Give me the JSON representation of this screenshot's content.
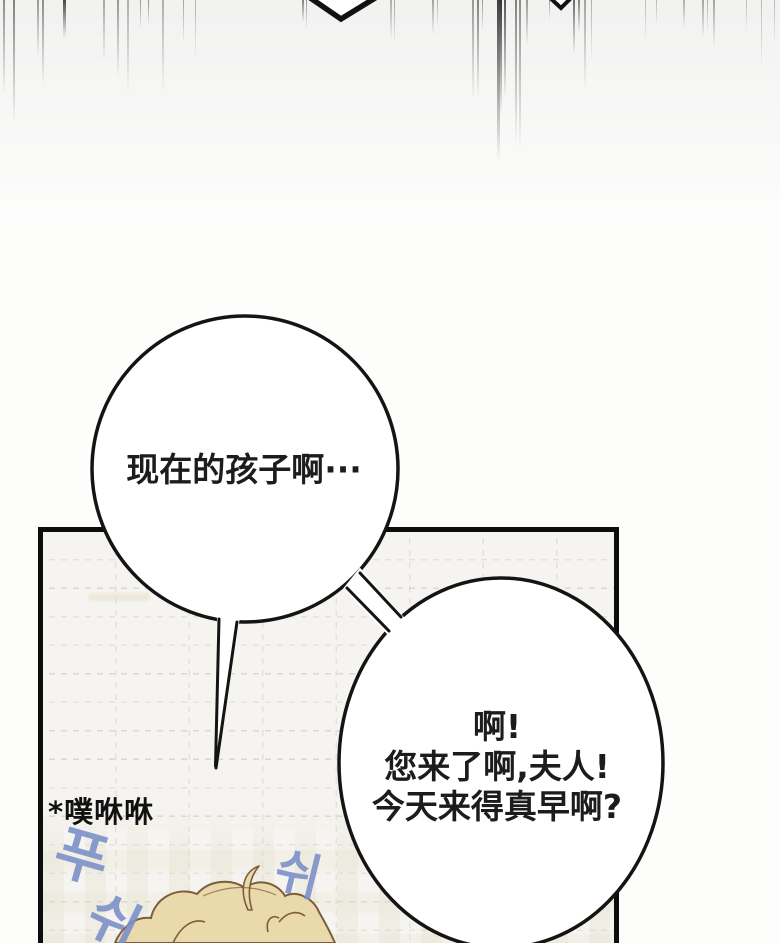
{
  "bubbles": {
    "bubble1": {
      "text": "现在的孩子啊···"
    },
    "bubble2": {
      "lines": [
        "啊!",
        "您来了啊,夫人!",
        "今天来得真早啊?"
      ]
    }
  },
  "caption": {
    "text": "*噗咻咻"
  },
  "sfx": {
    "left_top": {
      "text": "푸"
    },
    "left_bottom": {
      "text": "쉬"
    },
    "right": {
      "text": "쉬"
    }
  },
  "colors": {
    "ink": "#111111",
    "bubble_outline": "#141414",
    "bubble_fill": "#ffffff",
    "text": "#1c1c1c",
    "panel_bg": "#f5f4f0",
    "panel_border": "#0d0d0d",
    "hair_fill": "#ead9aa",
    "hair_line": "#7c5c3c",
    "sfx_blue": "#7a8ec9"
  },
  "speed_lines": [
    {
      "x": 3,
      "h": 95,
      "w": 2,
      "o": 0.45
    },
    {
      "x": 13,
      "h": 125,
      "w": 2,
      "o": 0.5
    },
    {
      "x": 37,
      "h": 58,
      "w": 1.5,
      "o": 0.4
    },
    {
      "x": 42,
      "h": 85,
      "w": 2,
      "o": 0.45
    },
    {
      "x": 63,
      "h": 38,
      "w": 2.5,
      "o": 0.75
    },
    {
      "x": 103,
      "h": 62,
      "w": 2,
      "o": 0.35
    },
    {
      "x": 117,
      "h": 78,
      "w": 1.5,
      "o": 0.4
    },
    {
      "x": 127,
      "h": 95,
      "w": 1.5,
      "o": 0.3
    },
    {
      "x": 140,
      "h": 30,
      "w": 1,
      "o": 0.4
    },
    {
      "x": 148,
      "h": 25,
      "w": 1,
      "o": 0.45
    },
    {
      "x": 162,
      "h": 93,
      "w": 1.5,
      "o": 0.3
    },
    {
      "x": 183,
      "h": 45,
      "w": 1,
      "o": 0.35
    },
    {
      "x": 195,
      "h": 60,
      "w": 1,
      "o": 0.3
    },
    {
      "x": 302,
      "h": 22,
      "w": 1.5,
      "o": 0.5
    },
    {
      "x": 306,
      "h": 30,
      "w": 1,
      "o": 0.4
    },
    {
      "x": 390,
      "h": 40,
      "w": 1.5,
      "o": 0.3
    },
    {
      "x": 394,
      "h": 45,
      "w": 1,
      "o": 0.35
    },
    {
      "x": 432,
      "h": 35,
      "w": 1.5,
      "o": 0.35
    },
    {
      "x": 437,
      "h": 28,
      "w": 1,
      "o": 0.3
    },
    {
      "x": 472,
      "h": 100,
      "w": 1.5,
      "o": 0.4
    },
    {
      "x": 477,
      "h": 97,
      "w": 1.5,
      "o": 0.5
    },
    {
      "x": 482,
      "h": 32,
      "w": 1,
      "o": 0.4
    },
    {
      "x": 497,
      "h": 162,
      "w": 2.5,
      "o": 0.8
    },
    {
      "x": 500,
      "h": 115,
      "w": 2,
      "o": 0.85
    },
    {
      "x": 504,
      "h": 98,
      "w": 2,
      "o": 0.7
    },
    {
      "x": 515,
      "h": 143,
      "w": 1.5,
      "o": 0.5
    },
    {
      "x": 519,
      "h": 150,
      "w": 1.5,
      "o": 0.45
    },
    {
      "x": 526,
      "h": 45,
      "w": 1.5,
      "o": 0.4
    },
    {
      "x": 549,
      "h": 20,
      "w": 1,
      "o": 0.4
    },
    {
      "x": 573,
      "h": 54,
      "w": 2,
      "o": 0.6
    },
    {
      "x": 578,
      "h": 32,
      "w": 1.5,
      "o": 0.5
    },
    {
      "x": 584,
      "h": 90,
      "w": 1.5,
      "o": 0.35
    },
    {
      "x": 591,
      "h": 62,
      "w": 1,
      "o": 0.3
    },
    {
      "x": 645,
      "h": 42,
      "w": 1,
      "o": 0.25
    },
    {
      "x": 656,
      "h": 26,
      "w": 1,
      "o": 0.25
    },
    {
      "x": 683,
      "h": 28,
      "w": 1.5,
      "o": 0.3
    },
    {
      "x": 702,
      "h": 38,
      "w": 1.5,
      "o": 0.35
    },
    {
      "x": 707,
      "h": 33,
      "w": 1,
      "o": 0.3
    },
    {
      "x": 713,
      "h": 48,
      "w": 1.5,
      "o": 0.35
    },
    {
      "x": 746,
      "h": 32,
      "w": 1,
      "o": 0.25
    },
    {
      "x": 761,
      "h": 72,
      "w": 1,
      "o": 0.25
    },
    {
      "x": 774,
      "h": 46,
      "w": 1,
      "o": 0.25
    }
  ]
}
